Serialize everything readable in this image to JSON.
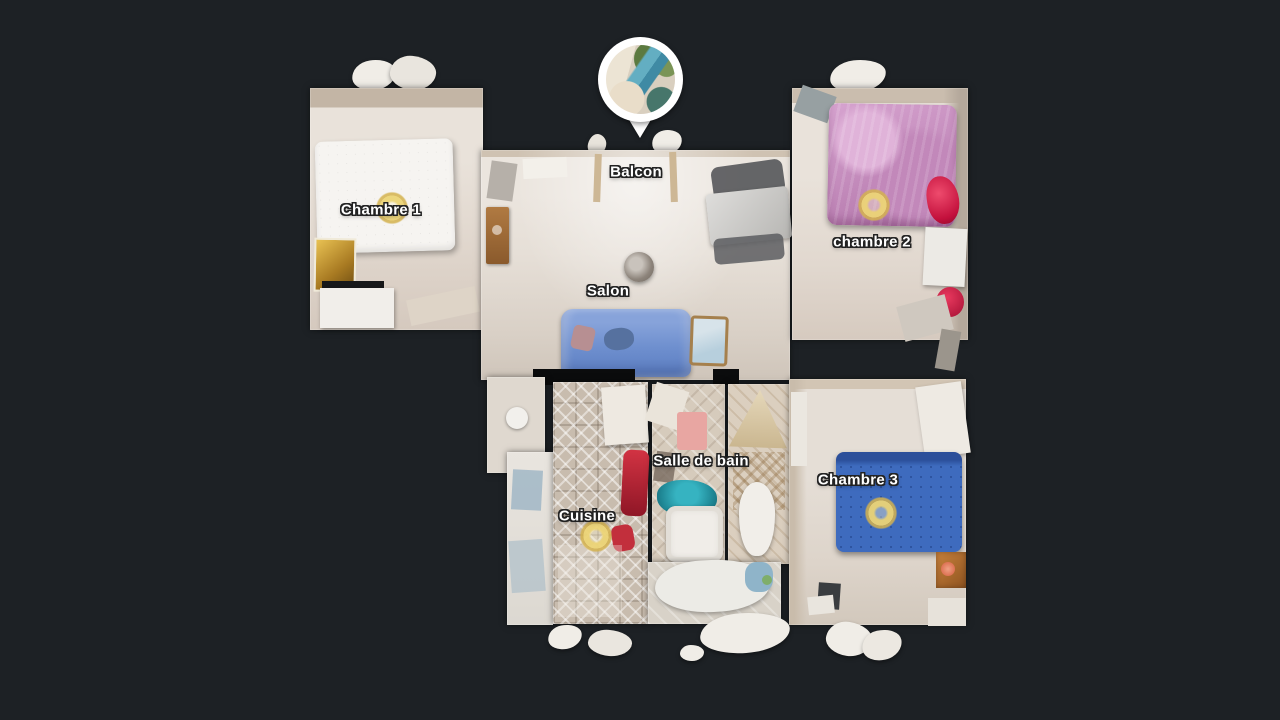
{
  "view": {
    "type": "3d-dollhouse-floorplan",
    "description": "Top-down 3D scan floor plan of an apartment"
  },
  "labels": {
    "balcon": "Balcon",
    "chambre1": "Chambre 1",
    "chambre2": "chambre 2",
    "salon": "Salon",
    "salle_de_bain": "Salle de bain",
    "cuisine": "Cuisine",
    "chambre3": "Chambre 3"
  },
  "icons": {
    "photo_pin": "balcony-photo-pin",
    "sweep_marker": "navigation-sweep-point"
  },
  "colors": {
    "background": "#1d2125",
    "label_text": "#ffffff",
    "label_outline": "#222222",
    "pin": "#ffffff",
    "sweep_marker_gold": "#ecd476",
    "sofa_blue": "#6f90cf",
    "bed_chambre2_pink": "#c78fc0",
    "bed_chambre3_blue": "#3e6bbe",
    "bathroom_teal": "#1f8795",
    "wall_dark": "#0b0c0d"
  }
}
